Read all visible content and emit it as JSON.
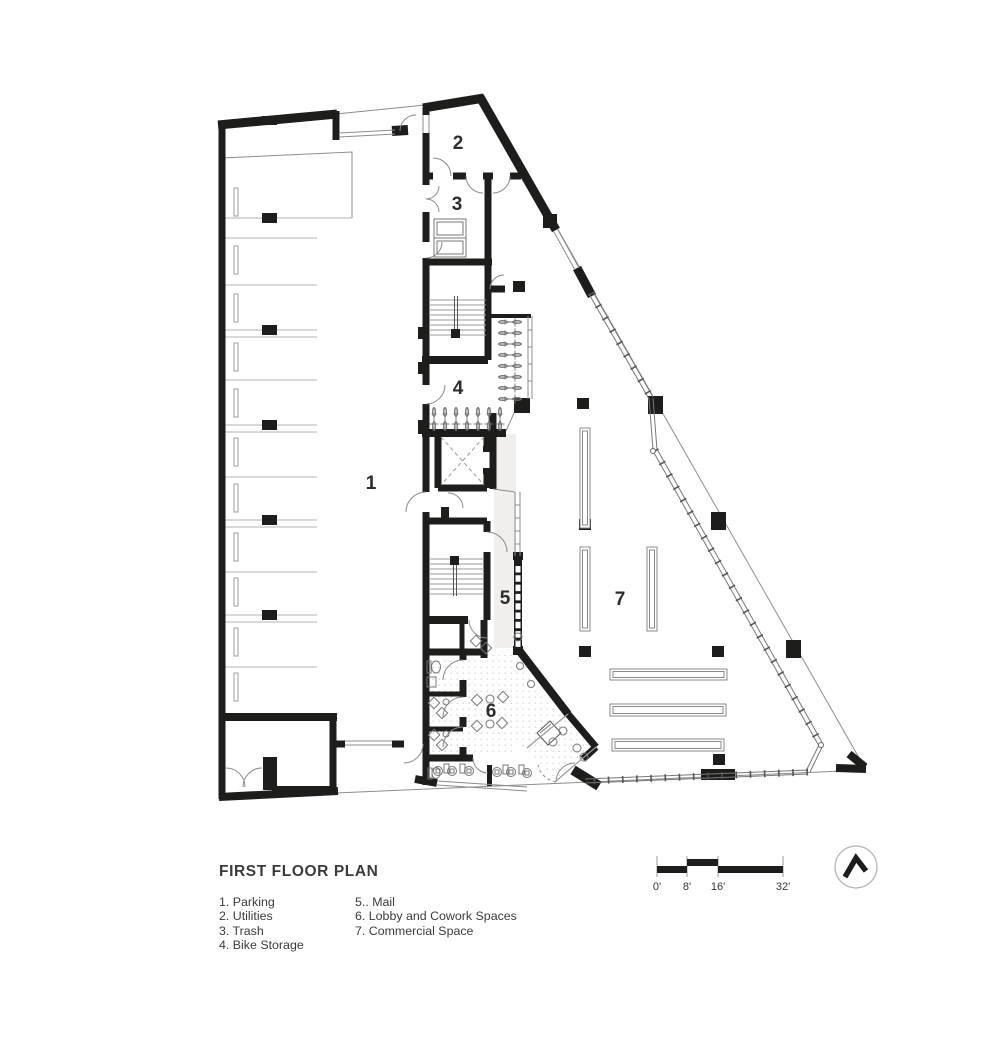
{
  "sheet": {
    "title": "FIRST FLOOR PLAN",
    "background": "#ffffff"
  },
  "plan": {
    "room_numbers": [
      "1",
      "2",
      "3",
      "4",
      "5",
      "6",
      "7"
    ]
  },
  "legend": {
    "column1": [
      "1. Parking",
      "2. Utilities",
      "3. Trash",
      "4. Bike Storage"
    ],
    "column2": [
      "5.. Mail",
      "6. Lobby and Cowork Spaces",
      "7. Commercial Space"
    ]
  },
  "scale_bar": {
    "tick_labels": [
      "0'",
      "8'",
      "16'",
      "32'"
    ]
  },
  "icons": {
    "north_arrow": "north-arrow-icon"
  },
  "colors": {
    "wall": "#1d1d1b",
    "thin_line": "#8c8c8c",
    "stall_line": "#b3b3b3",
    "text": "#3b3b3b",
    "corridor_fill": "#f0efee"
  }
}
